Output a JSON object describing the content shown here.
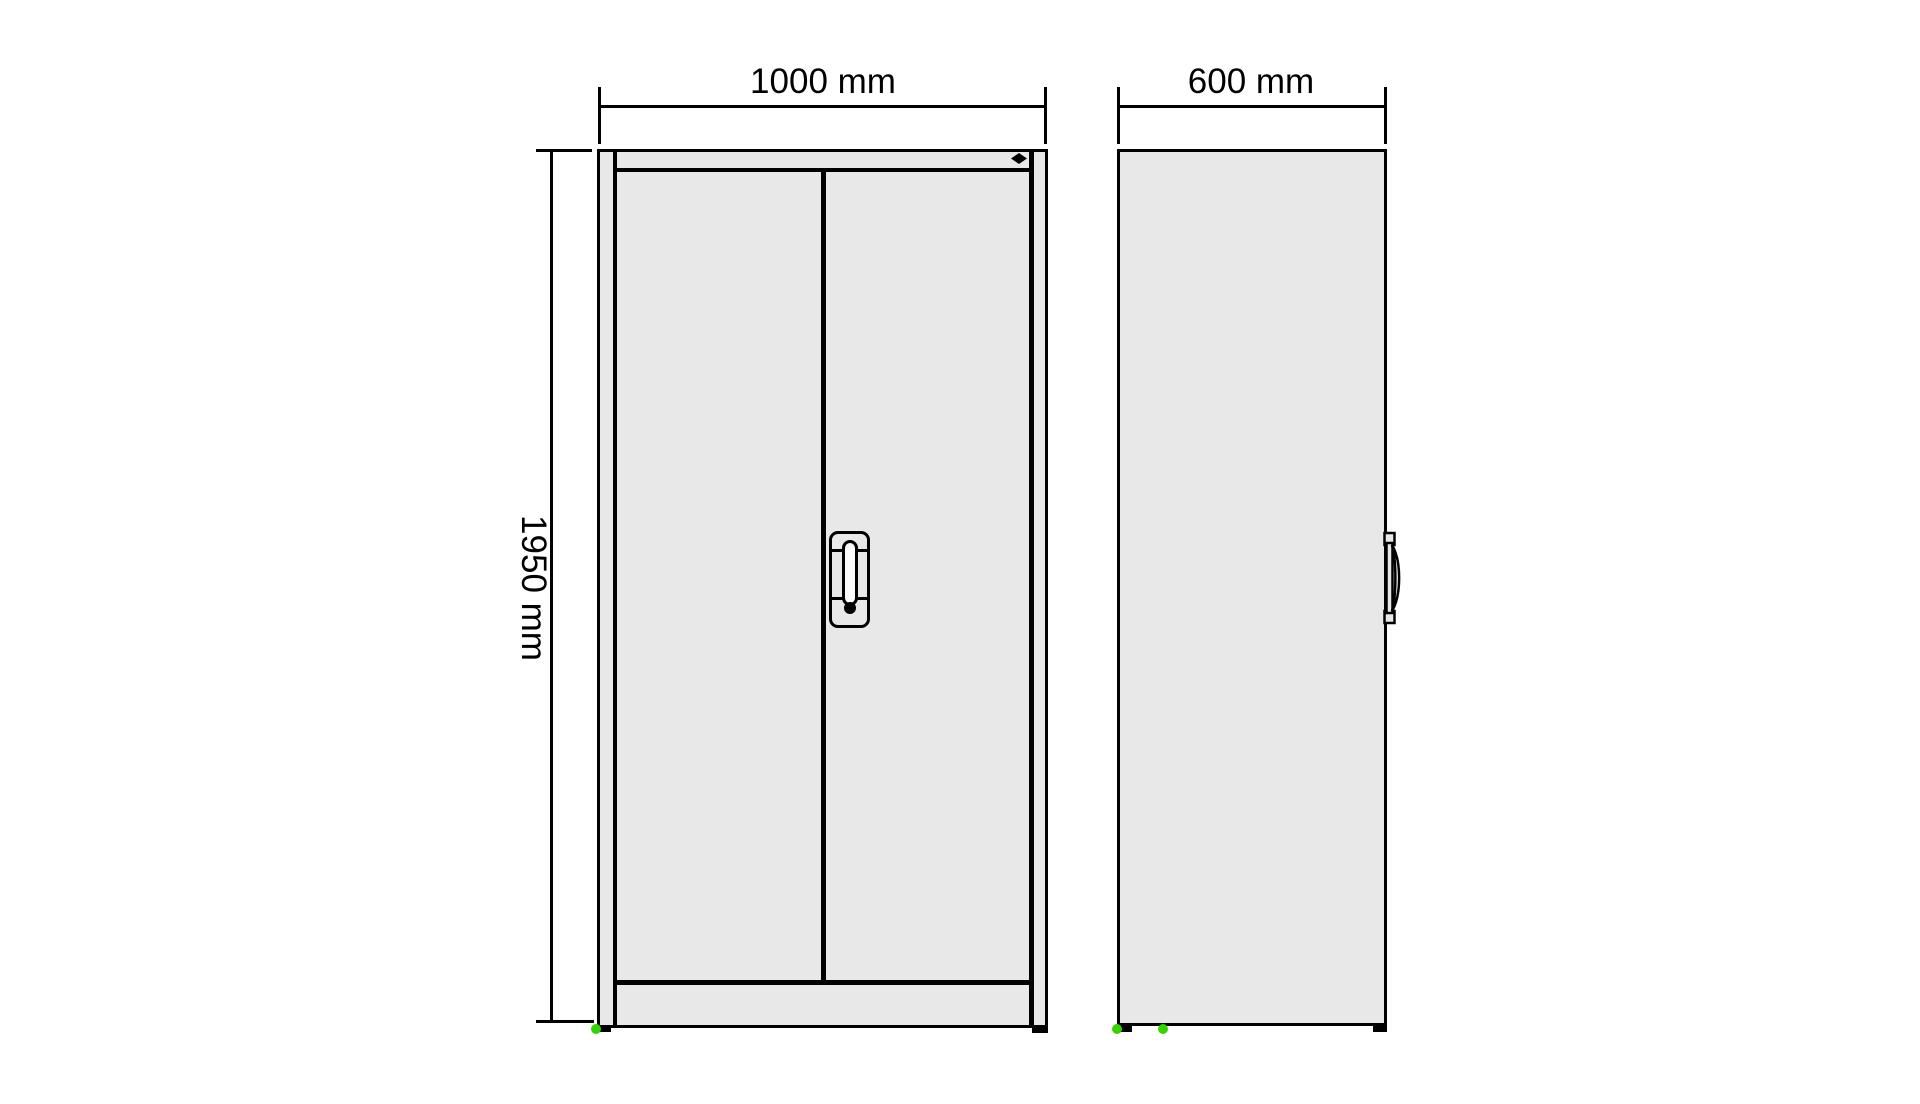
{
  "drawing": {
    "type": "technical-drawing",
    "subject": "two-door-cabinet-front-and-side-views",
    "dimensions": {
      "width": "1000 mm",
      "depth": "600 mm",
      "height": "1950 mm"
    },
    "colors": {
      "background": "#ffffff",
      "panel_fill": "#e8e8e8",
      "outline": "#000000",
      "foot_marker_green": "#33d400"
    },
    "icons": {
      "lock_marker": "diamond",
      "keyhole": "filled-circle",
      "handle_front": "recessed-grip-plate",
      "handle_side": "grip-profile"
    }
  }
}
